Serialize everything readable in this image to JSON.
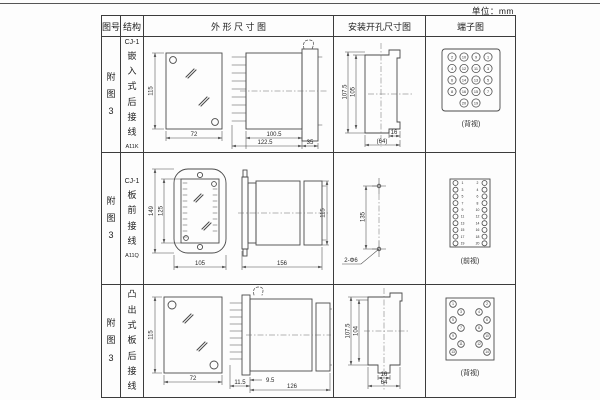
{
  "unit_label": "单位：mm",
  "table": {
    "headers": {
      "fig": "图号",
      "structure": "结构",
      "outline": "外 形 尺 寸 图",
      "mounting": "安装开孔尺寸图",
      "terminal": "端子图"
    }
  },
  "rows": [
    {
      "fig_no": "附图3",
      "model_prefix": "CJ-1",
      "structure": "嵌入式后接线",
      "model": "A11K",
      "outline": {
        "h": "115",
        "w": "72",
        "d1": "100.5",
        "d2": "122.5",
        "d3": "35"
      },
      "mount": {
        "v1": "107.5",
        "v2": "105",
        "h1": "16",
        "h2": "(64)"
      },
      "terminal": {
        "caption": "(背视)",
        "numbers": [
          "2",
          "10",
          "9",
          "1",
          "4",
          "12",
          "11",
          "3",
          "6",
          "14",
          "13",
          "5",
          "8",
          "16",
          "15",
          "7",
          "20",
          "19"
        ]
      }
    },
    {
      "fig_no": "附图3",
      "model_prefix": "CJ-1",
      "structure": "板前接线",
      "model": "A11Q",
      "outline": {
        "h": "149",
        "h2": "125",
        "w": "105",
        "d": "156",
        "sh": "115"
      },
      "mount": {
        "v1": "135",
        "holes": "2-Φ6"
      },
      "terminal": {
        "caption": "(前视)",
        "numbers": [
          "1",
          "3",
          "5",
          "7",
          "9",
          "11",
          "13",
          "15",
          "17",
          "19",
          "2",
          "4",
          "6",
          "8",
          "10",
          "12",
          "14",
          "16",
          "18",
          "20"
        ]
      }
    },
    {
      "fig_no": "附图3",
      "model_prefix": "CJ-1",
      "structure": "凸出式板后接线",
      "model": "A11H",
      "outline": {
        "h": "115",
        "w": "72",
        "d1": "11.5",
        "d2": "9.5",
        "d3": "126"
      },
      "mount": {
        "v1": "107.5",
        "v2": "104",
        "h1": "16",
        "h2": "64"
      },
      "terminal": {
        "caption": "(背视)",
        "numbers": [
          "1",
          "3",
          "5",
          "7",
          "9",
          "11",
          "13",
          "2",
          "4",
          "6",
          "8",
          "10",
          "12",
          "14"
        ]
      }
    }
  ]
}
